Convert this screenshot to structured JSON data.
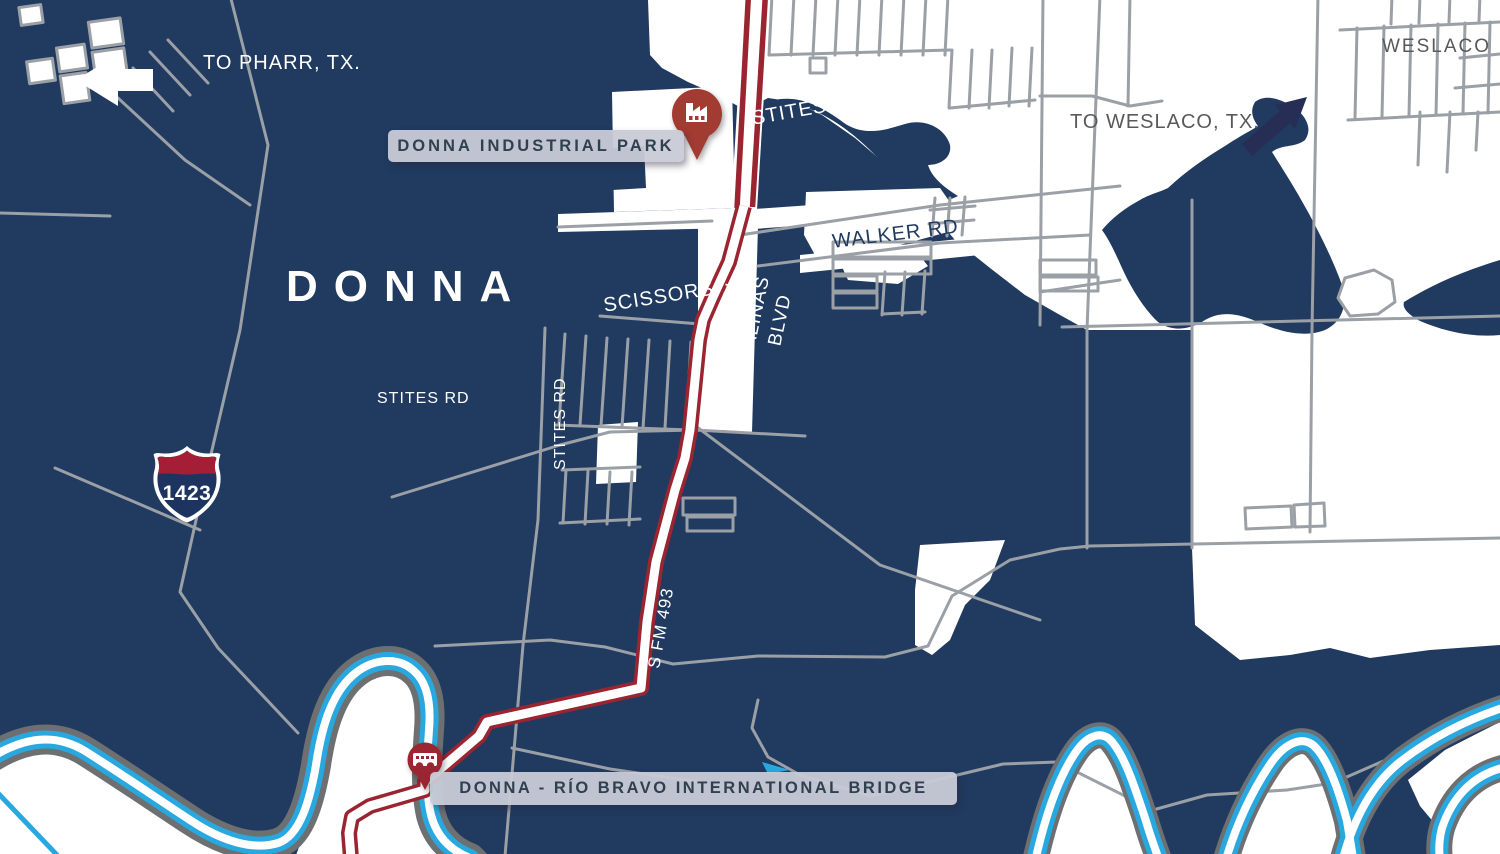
{
  "map": {
    "city_title": "DONNA",
    "neighbor_city": "WESLACO",
    "directions": {
      "pharr": "TO PHARR, TX.",
      "weslaco": "TO WESLACO, TX."
    },
    "roads": {
      "stites_top": "STITES RD",
      "stites_mid": "STITES RD",
      "stites_vertical": "STITES RD",
      "scissors": "SCISSORS",
      "salinas_1": "SOUTH",
      "salinas_2": "SALINAS",
      "salinas_3": "BLVD",
      "walker": "WALKER RD",
      "fm493": "S FM 493"
    },
    "highway_shield": {
      "number": "1423"
    },
    "markers": {
      "industrial_park": {
        "label": "DONNA INDUSTRIAL PARK",
        "icon": "factory-icon"
      },
      "bridge": {
        "label": "DONNA - RÍO BRAVO INTERNATIONAL BRIDGE",
        "icon": "bridge-icon"
      }
    },
    "colors": {
      "navy": "#203a60",
      "white": "#ffffff",
      "road_gray": "#9aa0a6",
      "river_casing": "#6d6f71",
      "river_cyan": "#29a8e0",
      "route_red": "#9a2531",
      "pin_red": "#a23a33",
      "pill_bg": "#c8cbd6",
      "pill_text": "#30404f",
      "muted_text": "#58595b",
      "arrow_navy": "#272e55"
    }
  }
}
